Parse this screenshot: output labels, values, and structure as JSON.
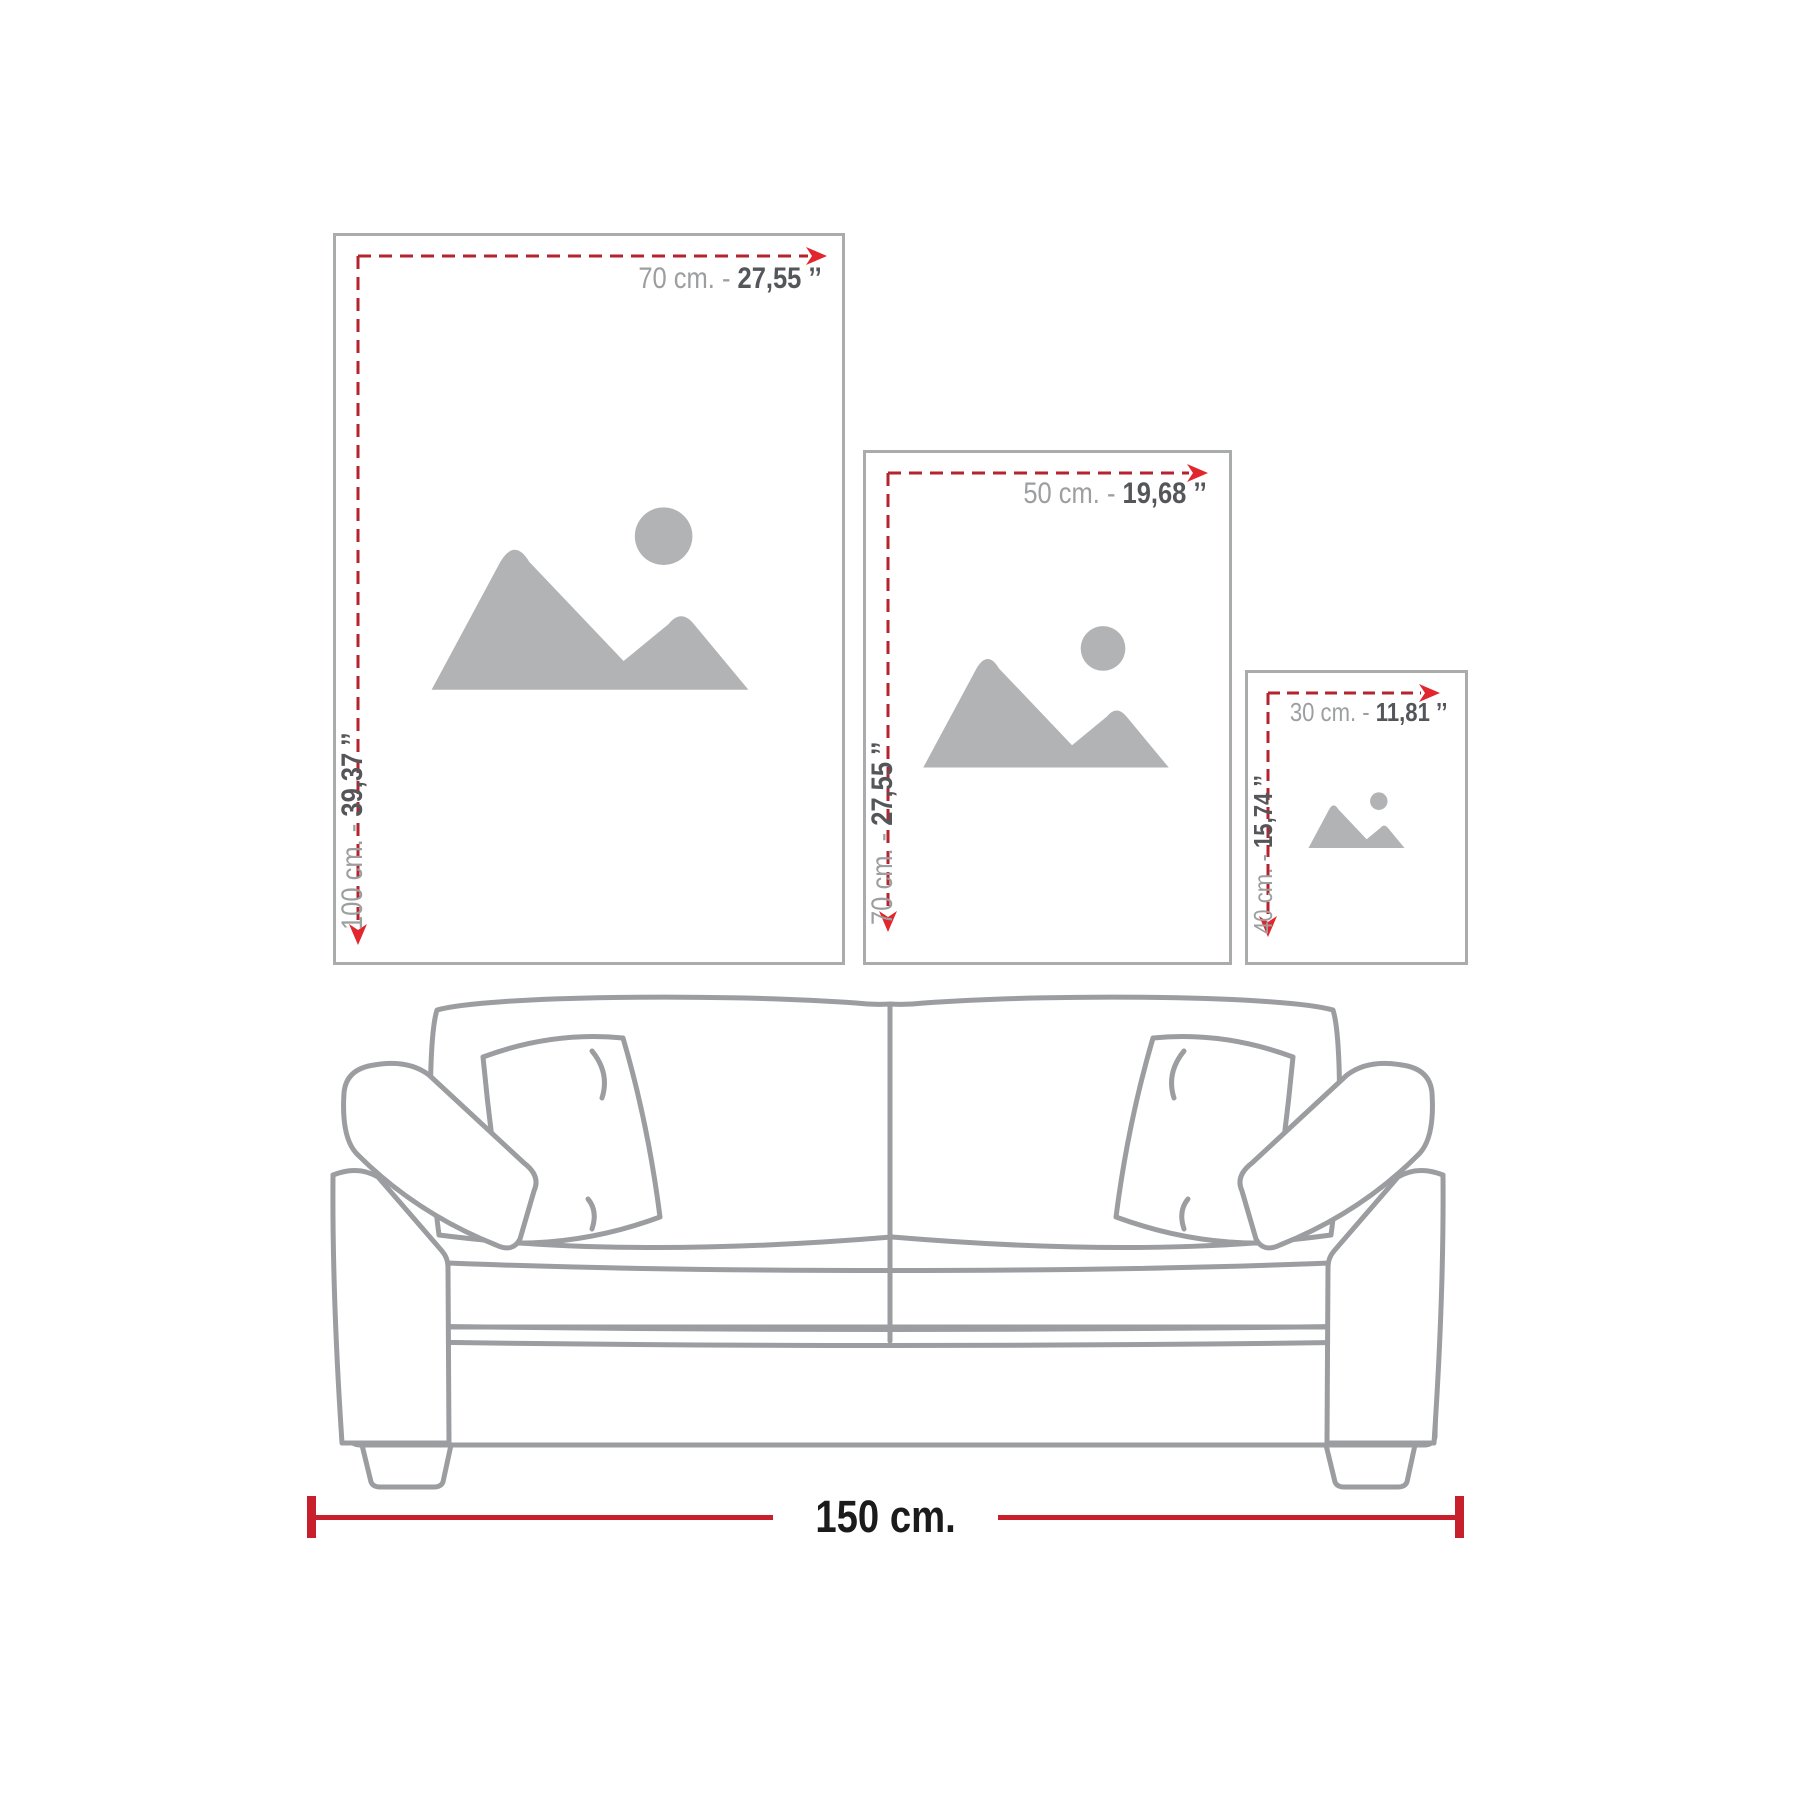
{
  "frames": [
    {
      "name": "large",
      "width_label": "70 cm. -",
      "width_inches": "27,55 ’’",
      "height_label": "100 cm. -",
      "height_inches": "39,37 ’’"
    },
    {
      "name": "medium",
      "width_label": "50 cm. -",
      "width_inches": "19,68 ’’",
      "height_label": "70 cm. -",
      "height_inches": "27,55 ’’"
    },
    {
      "name": "small",
      "width_label": "30 cm. -",
      "width_inches": "11,81 ’’",
      "height_label": "40 cm. -",
      "height_inches": "15,74 ’’"
    }
  ],
  "sofa": {
    "width_label": "150 cm."
  },
  "colors": {
    "dash_red": "#b5232e",
    "arrow_red": "#e2262e",
    "solid_red": "#c7202c",
    "frame_border_gray": "#a9abad",
    "icon_gray": "#b1b3b5",
    "label_light_gray": "#9c9ea0",
    "label_dark_gray": "#55565a",
    "measure_text": "#1b1b1b",
    "sofa_stroke": "#9b9da0"
  }
}
